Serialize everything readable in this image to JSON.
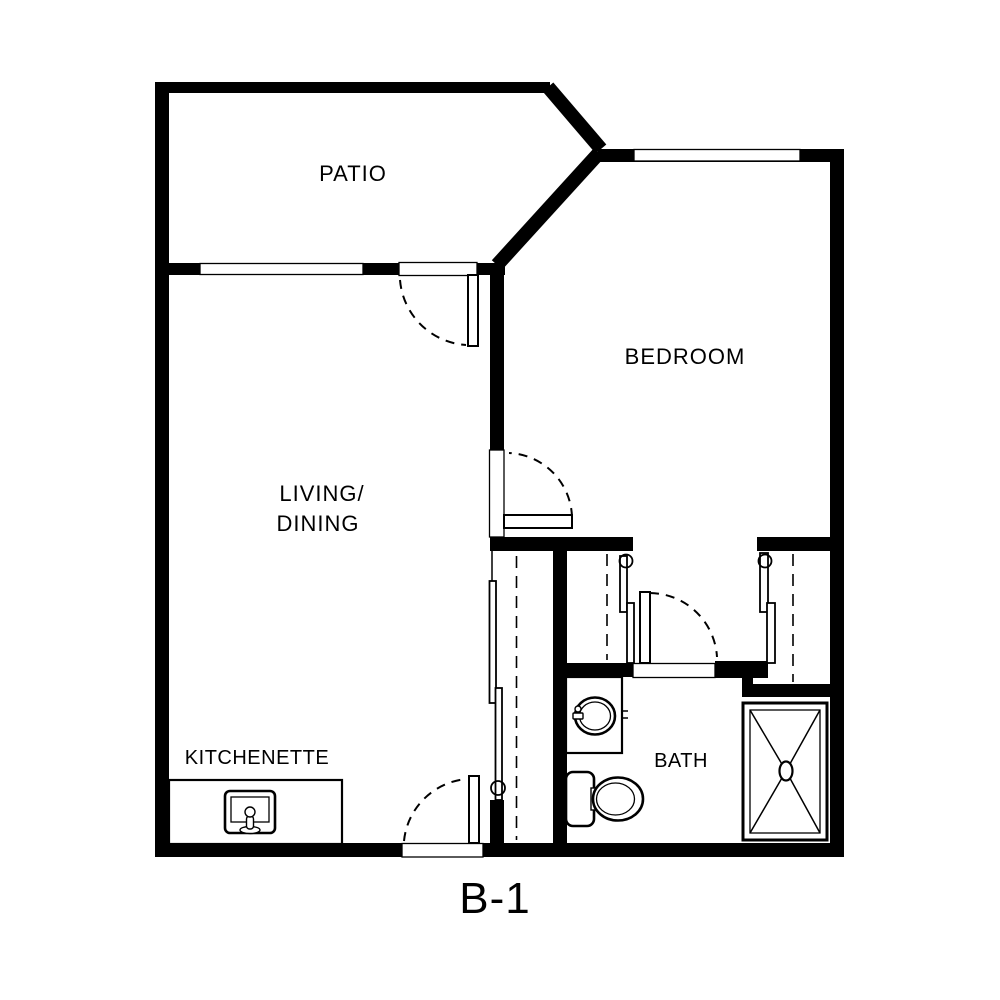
{
  "plan": {
    "title": "B-1",
    "type": "apartment-floor-plan",
    "background_color": "#ffffff",
    "wall_color": "#000000",
    "rooms": {
      "patio": {
        "label": "PATIO"
      },
      "bedroom": {
        "label": "BEDROOM"
      },
      "living_dining": {
        "line1": "LIVING/",
        "line2": "DINING"
      },
      "kitchenette": {
        "label": "KITCHENETTE"
      },
      "bath": {
        "label": "BATH"
      }
    },
    "fixtures": [
      "kitchen-sink",
      "vanity-sink",
      "toilet",
      "shower"
    ],
    "features": [
      "windows",
      "hinged-doors-with-swing-arcs",
      "sliding-closet-doors",
      "closet-rods"
    ]
  }
}
